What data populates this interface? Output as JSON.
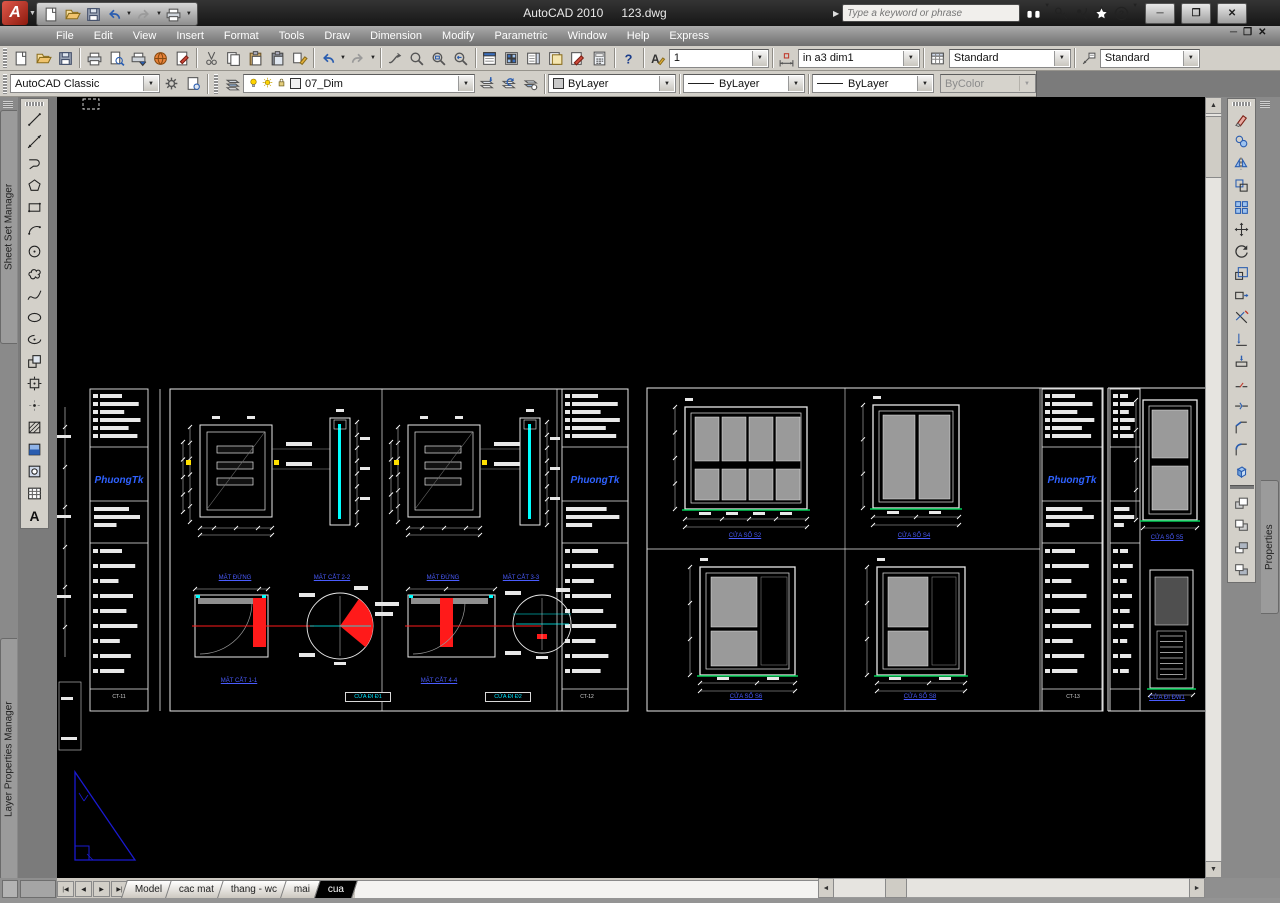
{
  "titlebar": {
    "app_title": "AutoCAD 2010",
    "doc_title": "123.dwg",
    "search_placeholder": "Type a keyword or phrase"
  },
  "window_controls": {
    "minimize": "─",
    "restore": "❐",
    "close": "✕"
  },
  "doc_controls": {
    "minimize": "─",
    "restore": "❐",
    "close": "✕"
  },
  "menus": [
    "File",
    "Edit",
    "View",
    "Insert",
    "Format",
    "Tools",
    "Draw",
    "Dimension",
    "Modify",
    "Parametric",
    "Window",
    "Help",
    "Express"
  ],
  "qat_icons": [
    "new",
    "open",
    "save",
    "undo",
    "redo",
    "plot"
  ],
  "infocenter_icons": [
    "search",
    "subscription-key",
    "communication-center",
    "favorites",
    "help-round"
  ],
  "toolbars": {
    "standard_icons": [
      "new",
      "open",
      "save",
      "plot",
      "plot-preview",
      "publish",
      "3d-dwf",
      "markup",
      "cut",
      "copy",
      "paste",
      "paste-special",
      "match-properties",
      "undo",
      "redo",
      "pan-realtime",
      "zoom-realtime",
      "zoom-window",
      "zoom-previous",
      "properties-palette",
      "designcenter",
      "tool-palettes",
      "sheet-set-manager",
      "markup-set-manager",
      "quickcalc",
      "help"
    ],
    "draw_icons": [
      "line",
      "construction-line",
      "polyline",
      "polygon",
      "rectangle",
      "arc",
      "circle",
      "revision-cloud",
      "spline",
      "ellipse",
      "ellipse-arc",
      "insert-block",
      "make-block",
      "point",
      "hatch",
      "gradient",
      "region",
      "table",
      "multiline-text"
    ],
    "modify_icons": [
      "erase",
      "copy-object",
      "mirror",
      "offset",
      "array",
      "move",
      "rotate",
      "scale",
      "stretch",
      "trim",
      "extend",
      "break-at-point",
      "break",
      "join",
      "chamfer",
      "fillet",
      "explode"
    ],
    "draworder_icons": [
      "bring-to-front",
      "send-to-back",
      "bring-above-objects",
      "send-under-objects"
    ],
    "workspace_icons": [
      "workspace-settings",
      "save-workspace"
    ],
    "layer_icons": [
      "layer-properties",
      "make-object-layer-current",
      "layer-previous",
      "layer-states"
    ]
  },
  "styles_toolbar": {
    "text_style": "1",
    "dim_style": "in a3 dim1",
    "table_style": "Standard",
    "mleader_style": "Standard"
  },
  "workspace": {
    "value": "AutoCAD Classic"
  },
  "layers": {
    "value": "07_Dim"
  },
  "properties_toolbar": {
    "color": "ByLayer",
    "linetype": "ByLayer",
    "lineweight": "ByLayer",
    "plot_style": "ByColor"
  },
  "palettes": {
    "left_top": "Sheet Set Manager",
    "left_bottom": "Layer Properties Manager",
    "right": "Properties"
  },
  "layout_tabs": {
    "nav": [
      "|◀",
      "◀",
      "▶",
      "▶|"
    ],
    "tabs": [
      "Model",
      "cac mat",
      "thang - wc",
      "mai",
      "cua"
    ],
    "active": "cua"
  },
  "colors": {
    "canvas_bg": "#000000",
    "sheet_line": "#e8e8e8",
    "cad_cyan": "#00ffff",
    "cad_red": "#ff1a1a",
    "cad_green": "#00cc55",
    "cad_yellow": "#ffe000",
    "cad_blue": "#1a1ad0",
    "brand_blue": "#2f62ff"
  },
  "canvas": {
    "labels": [
      {
        "cls": "cbrand",
        "x": 34,
        "y": 378,
        "w": 56,
        "text": "PhuongTk"
      },
      {
        "cls": "cbrand",
        "x": 505,
        "y": 378,
        "w": 66,
        "text": "PhuongTk"
      },
      {
        "cls": "cbrand",
        "x": 985,
        "y": 378,
        "w": 60,
        "text": "PhuongTk"
      },
      {
        "cls": "clbl",
        "x": 146,
        "y": 478,
        "w": 64,
        "text": "MẶT ĐỨNG"
      },
      {
        "cls": "clbl",
        "x": 243,
        "y": 478,
        "w": 64,
        "text": "MẶT CẮT 2-2"
      },
      {
        "cls": "clbl",
        "x": 354,
        "y": 478,
        "w": 64,
        "text": "MẶT ĐỨNG"
      },
      {
        "cls": "clbl",
        "x": 432,
        "y": 478,
        "w": 64,
        "text": "MẶT CẮT 3-3"
      },
      {
        "cls": "clbl",
        "x": 150,
        "y": 581,
        "w": 64,
        "text": "MẶT CẮT 1-1"
      },
      {
        "cls": "clbl",
        "x": 350,
        "y": 581,
        "w": 64,
        "text": "MẶT CẮT 4-4"
      },
      {
        "cls": "cbox",
        "x": 288,
        "y": 595,
        "w": 44,
        "text": "CỬA ĐI Đ1"
      },
      {
        "cls": "cbox",
        "x": 428,
        "y": 595,
        "w": 44,
        "text": "CỬA ĐI Đ2"
      },
      {
        "cls": "csheet",
        "x": 44,
        "y": 597,
        "w": 36,
        "text": "CT-11"
      },
      {
        "cls": "csheet",
        "x": 512,
        "y": 597,
        "w": 36,
        "text": "CT-12"
      },
      {
        "cls": "csheet",
        "x": 998,
        "y": 597,
        "w": 36,
        "text": "CT-13"
      },
      {
        "cls": "clbl",
        "x": 655,
        "y": 436,
        "w": 66,
        "text": "CỬA SỔ S2"
      },
      {
        "cls": "clbl",
        "x": 824,
        "y": 436,
        "w": 66,
        "text": "CỬA SỔ S4"
      },
      {
        "cls": "clbl",
        "x": 656,
        "y": 597,
        "w": 66,
        "text": "CỬA SỔ S6"
      },
      {
        "cls": "clbl",
        "x": 830,
        "y": 597,
        "w": 66,
        "text": "CỬA SỔ S8"
      },
      {
        "cls": "clbl",
        "x": 1080,
        "y": 438,
        "w": 60,
        "text": "CỬA SỔ S5"
      },
      {
        "cls": "clbl",
        "x": 1080,
        "y": 598,
        "w": 60,
        "text": "CỬA ĐI ĐW1"
      }
    ]
  }
}
